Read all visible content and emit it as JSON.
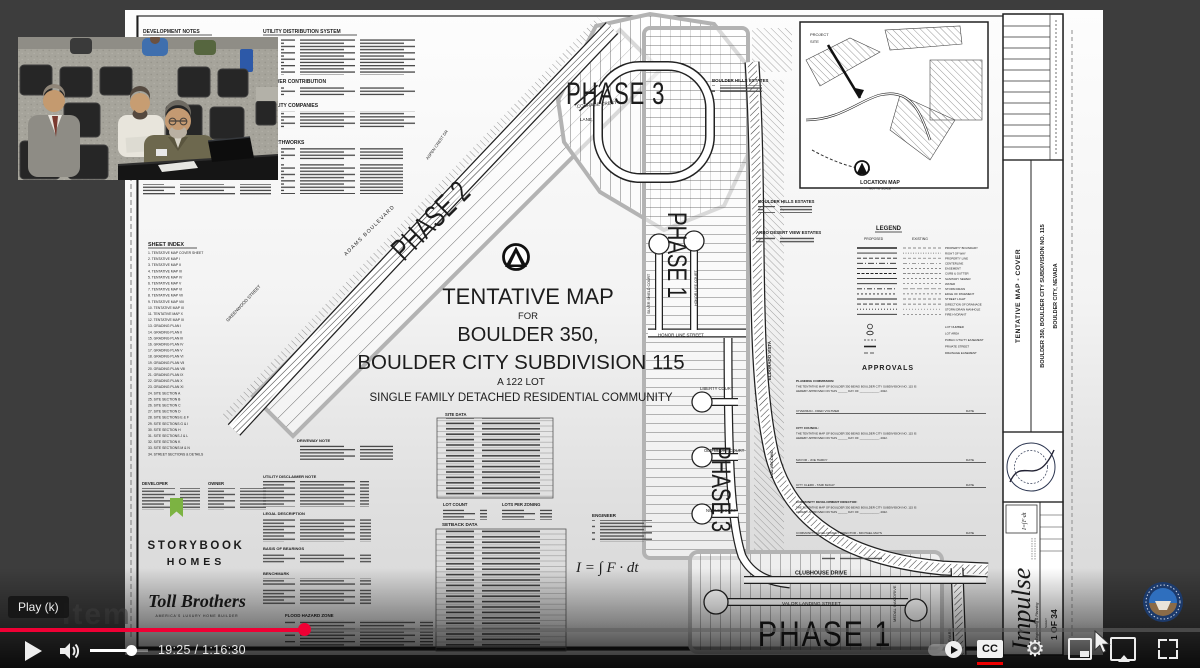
{
  "player": {
    "tooltip": "Play (k)",
    "watermark": "Item",
    "time": "19:25 / 1:16:30",
    "progress_fraction": 0.254,
    "progress_color": "#f00034",
    "cc_label": "CC"
  },
  "sheet": {
    "top_headings": {
      "development_notes": "DEVELOPMENT NOTES",
      "utility_distribution": "UTILITY DISTRIBUTION SYSTEM",
      "sewer_contribution": "SEWER CONTRIBUTION",
      "utility_companies": "UTILITY COMPANIES",
      "earthworks": "EARTHWORKS"
    },
    "index": {
      "title": "SHEET INDEX",
      "entries": [
        "1.   TENTATIVE MAP COVER SHEET",
        "2.   TENTATIVE MAP I",
        "3.   TENTATIVE MAP II",
        "4.   TENTATIVE MAP III",
        "5.   TENTATIVE MAP IV",
        "6.   TENTATIVE MAP V",
        "7.   TENTATIVE MAP VI",
        "8.   TENTATIVE MAP VII",
        "9.   TENTATIVE MAP VIII",
        "10.  TENTATIVE MAP IX",
        "11.  TENTATIVE MAP X",
        "12.  TENTATIVE MAP XI",
        "13.  GRADING PLAN I",
        "14.  GRADING PLAN II",
        "15.  GRADING PLAN III",
        "16.  GRADING PLAN IV",
        "17.  GRADING PLAN V",
        "18.  GRADING PLAN VI",
        "19.  GRADING PLAN VII",
        "20.  GRADING PLAN VIII",
        "21.  GRADING PLAN IX",
        "22.  GRADING PLAN X",
        "23.  GRADING PLAN XI",
        "24.  SITE SECTION A",
        "25.  SITE SECTION B",
        "26.  SITE SECTION C",
        "27.  SITE SECTION D",
        "28.  SITE SECTIONS E & F",
        "29.  SITE SECTIONS G & I",
        "30.  SITE SECTION H",
        "31.  SITE SECTIONS J & L",
        "32.  SITE SECTION K",
        "33.  SITE SECTIONS M & N",
        "34.  STREET SECTIONS & DETAILS"
      ]
    },
    "title": {
      "line1": "TENTATIVE MAP",
      "line2": "FOR",
      "line3": "BOULDER 350,",
      "line4": "BOULDER CITY SUBDIVISION 115",
      "line5": "A 122 LOT",
      "line6": "SINGLE FAMILY DETACHED RESIDENTIAL COMMUNITY"
    },
    "parties": {
      "developer": "DEVELOPER",
      "owner": "OWNER",
      "storybook1": "STORYBOOK",
      "storybook2": "HOMES",
      "toll": "Toll Brothers",
      "toll_tagline": "AMERICA'S LUXURY HOME BUILDER",
      "storybook_color": "#2f7f93",
      "toll_color": "#24355e"
    },
    "notes": {
      "driveway": "DRIVEWAY NOTE",
      "utility_disclaimer": "UTILITY DISCLAIMER NOTE",
      "legal": "LEGAL DESCRIPTION",
      "basis": "BASIS OF BEARINGS",
      "benchmark": "BENCHMARK",
      "flood": "FLOOD HAZARD ZONE"
    },
    "tables": {
      "site_data": "SITE DATA",
      "lot_count": "LOT COUNT",
      "lots_per_zoning": "LOTS PER ZONING",
      "setback_data": "SETBACK DATA",
      "engineer": "ENGINEER",
      "equation": "I = ∫ F · dt"
    },
    "legend": {
      "title": "LEGEND",
      "proposed": "PROPOSED",
      "existing": "EXISTING",
      "items": [
        "PROPERTY BOUNDARY",
        "RIGHT OF WAY",
        "PROPERTY LINE",
        "CENTERLINE",
        "EASEMENT",
        "CURB & GUTTER",
        "SANITARY SEWER",
        "WATER",
        "STORM DRAIN",
        "EDGE OF PAVEMENT",
        "STREET LIGHT",
        "DIRECTION OF DRAINAGE",
        "STORM DRAIN MANHOLE",
        "FIRE HYDRANT"
      ],
      "items2": [
        "LOT NUMBER",
        "LOT AREA",
        "PUBLIC UTILITY EASEMENT",
        "PRIVATE STREET",
        "DRAINAGE EASEMENT"
      ]
    },
    "approvals": {
      "title": "APPROVALS",
      "planning_label": "PLANNING COMMISSION:",
      "body1": "THE TENTATIVE MAP OF BOULDER 350 BEING BOULDER CITY SUBDIVISION NO. 115 IS",
      "body2": "HEREBY APPROVED ON THIS ______ DAY OF ____________, 2022.",
      "chairman": "CHAIRMAN - FRED VOLTMER",
      "council_label": "CITY COUNCIL:",
      "mayor": "MAYOR - JOE HARDY",
      "clerk": "CITY CLERK - TAMI McKAY",
      "cdd_label": "COMMUNITY DEVELOPMENT DIRECTOR:",
      "cdd": "COMMUNITY DEVELOPMENT DIRECTOR - MICHAEL MAYS",
      "date": "DATE"
    },
    "map": {
      "phase3_top": "PHASE 3",
      "phase2": "PHASE 2",
      "phase1_mid": "PHASE 1",
      "phase3_low": "PHASE 3",
      "phase1_bottom": "PHASE 1",
      "adams": "ADAMS BOULEVARD",
      "greenwood": "GREENWOOD STREET",
      "aspen": "ASPEN CREST DR",
      "courage1": "COURAGE CREST",
      "courage2": "LANE",
      "honor_line": "HONOR LINE STREET",
      "silver_shield": "SILVER SHIELD COURT",
      "honor_life": "HONOR LIFE COURT",
      "liberty": "LIBERTY COURT",
      "old_glory": "OLD GLORY COURT",
      "noble": "NOBLE COURT",
      "valor": "VALOR LANDING STREET",
      "clubhouse": "CLUBHOUSE DRIVE",
      "medal_oak": "MEDAL OAK DRIVE",
      "boulevard": "BOULEVARD",
      "bh1": "BOULDER HILLS ESTATES",
      "bh2": "BOULDER HILLS ESTATES",
      "arbo": "ARBO DESERT VIEW ESTATES",
      "eldorado": "ELDORADO VISTA",
      "lou": "LOU VECCHIO"
    },
    "location_map": {
      "project_site1": "PROJECT",
      "project_site2": "SITE",
      "title": "LOCATION MAP",
      "subtitle": "NOT TO SCALE"
    },
    "title_block": {
      "vertical_title": "TENTATIVE MAP - COVER",
      "vertical_project": "BOULDER 350, BOULDER CITY SUBDIVISION NO. 115",
      "vertical_location": "BOULDER CITY, NEVADA",
      "firm": "Impulse",
      "firm_sub": "Civil Engineering & Planning",
      "firm_formula": "I=∫F·dt",
      "sheet_label": "SHEET",
      "sheet_no": "1 OF 34"
    }
  }
}
